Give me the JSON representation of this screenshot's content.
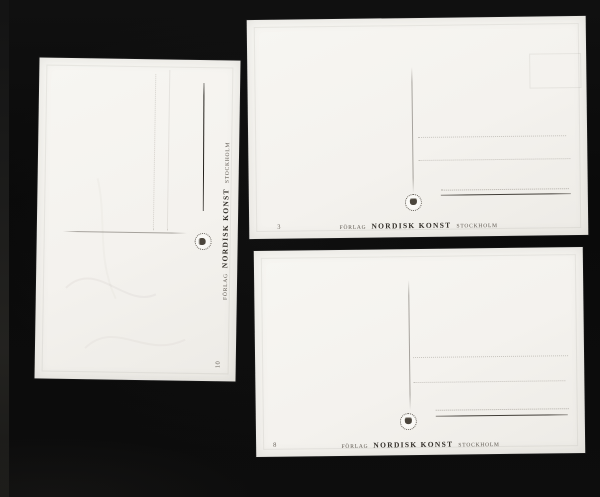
{
  "scene": {
    "description": "Three blank postcard backs by Nordisk Konst publisher photographed on a black background",
    "background_color": "#0a0a0a",
    "card_color": "#f4f2ee",
    "line_color": "#5f584e",
    "ink_color": "#332f29"
  },
  "publisher": {
    "prefix": "FÖRLAG",
    "name": "NORDISK KONST",
    "city": "STOCKHOLM"
  },
  "stamp_icon": "round-publisher-stamp",
  "cards": [
    {
      "position": "left",
      "number": "10",
      "rotation": "90-ccw"
    },
    {
      "position": "top-right",
      "number": "3",
      "rotation": "none"
    },
    {
      "position": "bottom-right",
      "number": "8",
      "rotation": "none"
    }
  ]
}
